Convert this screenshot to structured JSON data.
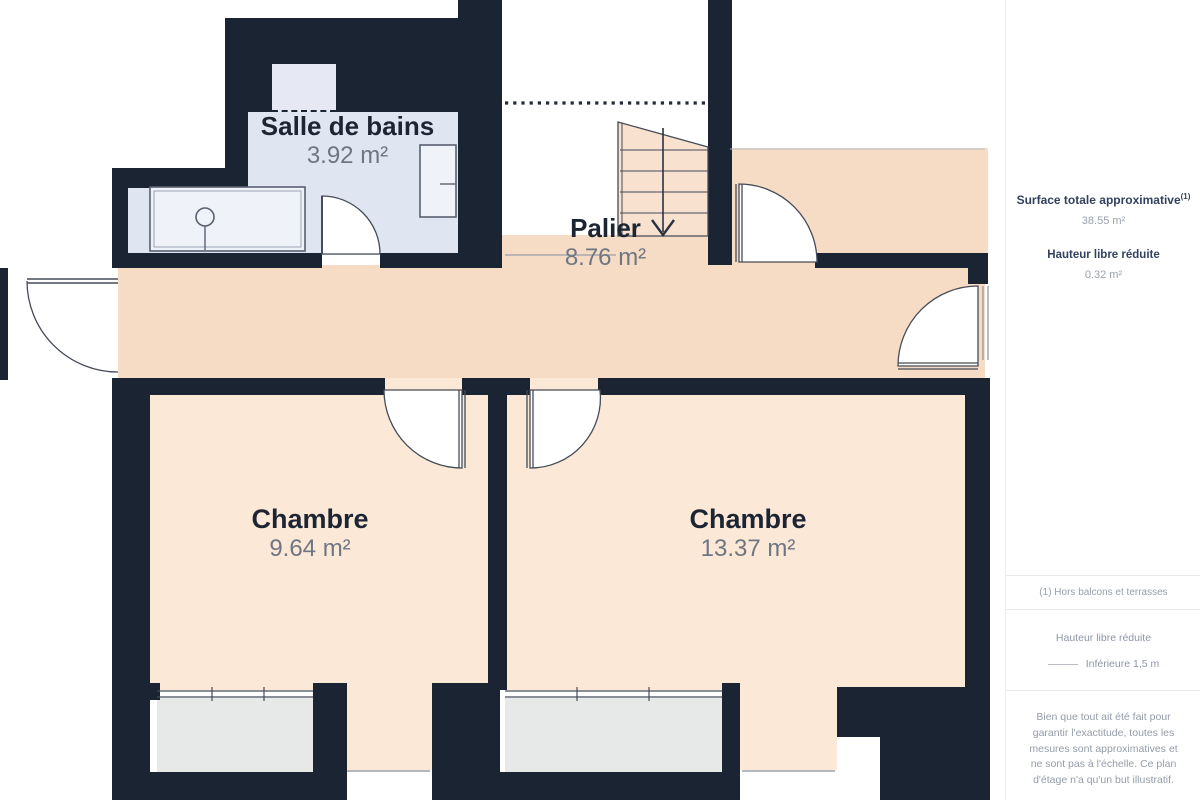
{
  "plan": {
    "rooms": [
      {
        "name": "Salle de bains",
        "area": "3.92 m²"
      },
      {
        "name": "Palier",
        "area": "8.76 m²"
      },
      {
        "name": "Chambre",
        "area": "9.64 m²"
      },
      {
        "name": "Chambre",
        "area": "13.37 m²"
      }
    ]
  },
  "sidebar": {
    "surface_title": "Surface totale approximative",
    "surface_sup": "(1)",
    "surface_value": "38.55 m²",
    "height_title": "Hauteur libre réduite",
    "height_value": "0.32 m²",
    "footnote": "(1) Hors balcons et terrasses",
    "legend_title": "Hauteur libre réduite",
    "legend_item": "Inférieure 1,5 m",
    "disclaimer": "Bien que tout ait été fait pour garantir l'exactitude, toutes les mesures sont approximatives et ne sont pas à l'échelle. Ce plan d'étage n'a qu'un but illustratif.",
    "disclaimer2": "Les calculs sont basés sur le standard"
  },
  "colors": {
    "wall": "#1b2432",
    "corridor_floor": "#f6dbc5",
    "bedroom_floor": "#fbe8d7",
    "bathroom_floor": "#e0e5f2",
    "window_bay": "#e7e9e9",
    "label_dark": "#1d2533",
    "label_gray": "#6f7683",
    "sidebar_navy": "#33415f",
    "sidebar_gray": "#98a0ac"
  }
}
